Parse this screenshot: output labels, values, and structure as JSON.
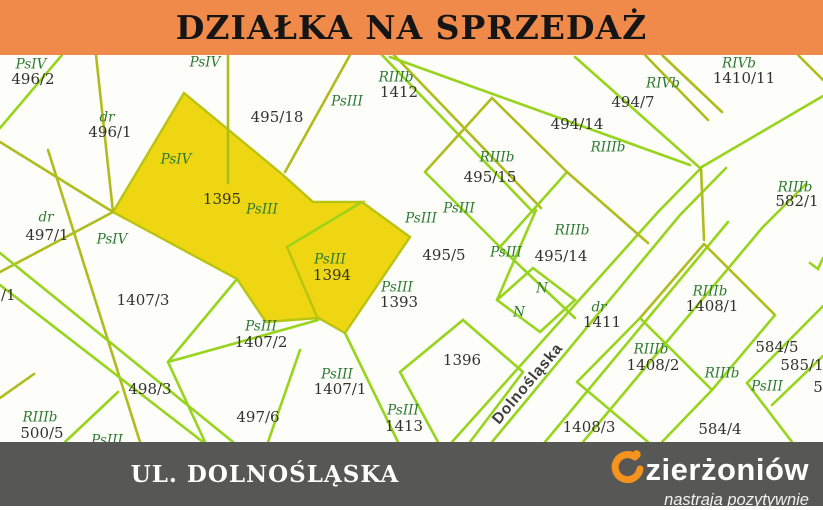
{
  "header": {
    "title": "DZIAŁKA NA SPRZEDAŻ",
    "bg": "#f08a4b",
    "text_color": "#151515"
  },
  "footer": {
    "street_banner": "UL. DOLNOŚLĄSKA",
    "bg": "#575755",
    "logo": {
      "name_rest": "zierżoniów",
      "tagline": "nastraja pozytywnie",
      "accent": "#f6921e",
      "d_icon": "orange-swirl-D"
    }
  },
  "map": {
    "background": "#fdfdfa",
    "line_colors": {
      "bright": "#97d41c",
      "olive": "#b0bc1e"
    },
    "highlight": {
      "fill": "#eed712",
      "stroke": "#b9c410"
    },
    "label_colors": {
      "code": "#2d7a32",
      "number": "#32322c",
      "street": "#3d3d3d"
    },
    "highlighted_parcels": [
      {
        "number": "1395",
        "code": "PsIII"
      },
      {
        "number": "1394",
        "code": "PsIII"
      }
    ],
    "street": {
      "name": "Dolnośląska",
      "x": 528,
      "y": 384,
      "angle": -50
    },
    "labels": [
      {
        "t": "PsIV",
        "k": "code",
        "x": 31,
        "y": 65
      },
      {
        "t": "496/2",
        "k": "num",
        "x": 33,
        "y": 80
      },
      {
        "t": "dr",
        "k": "code",
        "x": 107,
        "y": 118
      },
      {
        "t": "496/1",
        "k": "num",
        "x": 110,
        "y": 133
      },
      {
        "t": "PsIV",
        "k": "code",
        "x": 205,
        "y": 63
      },
      {
        "t": "495/18",
        "k": "num",
        "x": 277,
        "y": 118
      },
      {
        "t": "PsIII",
        "k": "code",
        "x": 347,
        "y": 102
      },
      {
        "t": "RIIIb",
        "k": "code",
        "x": 396,
        "y": 78
      },
      {
        "t": "1412",
        "k": "num",
        "x": 399,
        "y": 93
      },
      {
        "t": "PsIV",
        "k": "code",
        "x": 176,
        "y": 160
      },
      {
        "t": "1395",
        "k": "num",
        "x": 222,
        "y": 200
      },
      {
        "t": "PsIII",
        "k": "code",
        "x": 262,
        "y": 210
      },
      {
        "t": "dr",
        "k": "code",
        "x": 46,
        "y": 218
      },
      {
        "t": "497/1",
        "k": "num",
        "x": 47,
        "y": 236
      },
      {
        "t": "PsIV",
        "k": "code",
        "x": 112,
        "y": 240
      },
      {
        "t": "498/1",
        "k": "num",
        "x": -6,
        "y": 296
      },
      {
        "t": "PsIII",
        "k": "code",
        "x": 330,
        "y": 260
      },
      {
        "t": "1394",
        "k": "num",
        "x": 332,
        "y": 276
      },
      {
        "t": "PsIII",
        "k": "code",
        "x": 397,
        "y": 288
      },
      {
        "t": "1393",
        "k": "num",
        "x": 399,
        "y": 303
      },
      {
        "t": "PsIII",
        "k": "code",
        "x": 421,
        "y": 219
      },
      {
        "t": "PsIII",
        "k": "code",
        "x": 459,
        "y": 209
      },
      {
        "t": "495/5",
        "k": "num",
        "x": 444,
        "y": 256
      },
      {
        "t": "PsIII",
        "k": "code",
        "x": 506,
        "y": 253
      },
      {
        "t": "RIIIb",
        "k": "code",
        "x": 497,
        "y": 158
      },
      {
        "t": "495/15",
        "k": "num",
        "x": 490,
        "y": 178
      },
      {
        "t": "RIIIb",
        "k": "code",
        "x": 572,
        "y": 231
      },
      {
        "t": "495/14",
        "k": "num",
        "x": 561,
        "y": 257
      },
      {
        "t": "494/14",
        "k": "num",
        "x": 577,
        "y": 125
      },
      {
        "t": "494/7",
        "k": "num",
        "x": 633,
        "y": 103
      },
      {
        "t": "RIIIb",
        "k": "code",
        "x": 608,
        "y": 148
      },
      {
        "t": "RIVb",
        "k": "code",
        "x": 663,
        "y": 84
      },
      {
        "t": "RIVb",
        "k": "code",
        "x": 739,
        "y": 64
      },
      {
        "t": "1410/11",
        "k": "num",
        "x": 744,
        "y": 79
      },
      {
        "t": "RIIIb",
        "k": "code",
        "x": 795,
        "y": 188
      },
      {
        "t": "582/1",
        "k": "num",
        "x": 797,
        "y": 202
      },
      {
        "t": "N",
        "k": "code",
        "x": 542,
        "y": 289
      },
      {
        "t": "N",
        "k": "code",
        "x": 519,
        "y": 313
      },
      {
        "t": "dr",
        "k": "code",
        "x": 599,
        "y": 308
      },
      {
        "t": "1411",
        "k": "num",
        "x": 602,
        "y": 323
      },
      {
        "t": "1407/3",
        "k": "num",
        "x": 143,
        "y": 301
      },
      {
        "t": "PsIII",
        "k": "code",
        "x": 261,
        "y": 327
      },
      {
        "t": "1407/2",
        "k": "num",
        "x": 261,
        "y": 343
      },
      {
        "t": "498/3",
        "k": "num",
        "x": 150,
        "y": 390
      },
      {
        "t": "497/6",
        "k": "num",
        "x": 258,
        "y": 418
      },
      {
        "t": "PsIII",
        "k": "code",
        "x": 337,
        "y": 375
      },
      {
        "t": "1407/1",
        "k": "num",
        "x": 340,
        "y": 390
      },
      {
        "t": "1396",
        "k": "num",
        "x": 462,
        "y": 361
      },
      {
        "t": "PsIII",
        "k": "code",
        "x": 403,
        "y": 411
      },
      {
        "t": "1413",
        "k": "num",
        "x": 404,
        "y": 427
      },
      {
        "t": "RIIIb",
        "k": "code",
        "x": 40,
        "y": 418
      },
      {
        "t": "500/5",
        "k": "num",
        "x": 42,
        "y": 434
      },
      {
        "t": "PsIII",
        "k": "code",
        "x": 107,
        "y": 441
      },
      {
        "t": "1408/3",
        "k": "num",
        "x": 589,
        "y": 428
      },
      {
        "t": "RIIIb",
        "k": "code",
        "x": 710,
        "y": 292
      },
      {
        "t": "1408/1",
        "k": "num",
        "x": 712,
        "y": 307
      },
      {
        "t": "RIIIb",
        "k": "code",
        "x": 651,
        "y": 350
      },
      {
        "t": "1408/2",
        "k": "num",
        "x": 653,
        "y": 366
      },
      {
        "t": "RIIIb",
        "k": "code",
        "x": 722,
        "y": 374
      },
      {
        "t": "584/5",
        "k": "num",
        "x": 777,
        "y": 348
      },
      {
        "t": "585/1",
        "k": "num",
        "x": 802,
        "y": 366
      },
      {
        "t": "PsIII",
        "k": "code",
        "x": 767,
        "y": 387
      },
      {
        "t": "5",
        "k": "num",
        "x": 818,
        "y": 388
      },
      {
        "t": "584/4",
        "k": "num",
        "x": 720,
        "y": 430
      }
    ],
    "polygons": [
      {
        "name": "parcel-1395",
        "pts": "184,93 283,175 313,202 362,202 287,247 318,318 266,322 237,279 113,212"
      },
      {
        "name": "parcel-1394",
        "pts": "287,247 362,202 410,237 345,333 317,317"
      }
    ],
    "lines": [
      {
        "c": "olive",
        "p": "0,142 113,212"
      },
      {
        "c": "olive",
        "p": "113,212 0,272"
      },
      {
        "c": "olive",
        "p": "96,55 113,212"
      },
      {
        "c": "bright",
        "p": "62,55 0,128"
      },
      {
        "c": "olive",
        "p": "48,150 140,442"
      },
      {
        "c": "bright",
        "p": "0,253 233,442"
      },
      {
        "c": "bright",
        "p": "0,285 203,442"
      },
      {
        "c": "bright",
        "p": "65,442 118,392"
      },
      {
        "c": "olive",
        "p": "0,398 34,374"
      },
      {
        "c": "olive",
        "p": "228,55 228,183"
      },
      {
        "c": "olive",
        "p": "350,55 285,172"
      },
      {
        "c": "bright",
        "p": "382,55 533,212"
      },
      {
        "c": "olive",
        "p": "394,55 541,208"
      },
      {
        "c": "bright",
        "p": "390,57 690,165"
      },
      {
        "c": "bright",
        "p": "536,210 497,300"
      },
      {
        "c": "bright",
        "p": "237,279 168,362"
      },
      {
        "c": "bright",
        "p": "168,362 247,340 318,320"
      },
      {
        "c": "bright",
        "p": "168,362 205,442"
      },
      {
        "c": "bright",
        "p": "300,350 268,442"
      },
      {
        "c": "bright",
        "p": "345,333 398,442"
      },
      {
        "c": "bright",
        "p": "400,372 463,320 523,372"
      },
      {
        "c": "bright",
        "p": "523,372 470,442"
      },
      {
        "c": "bright",
        "p": "400,372 438,442"
      },
      {
        "c": "bright",
        "p": "452,442 658,212 703,166"
      },
      {
        "c": "bright",
        "p": "492,442 680,215 726,168"
      },
      {
        "c": "bright",
        "p": "545,442 728,222"
      },
      {
        "c": "bright",
        "p": "583,442 762,228 806,184"
      },
      {
        "c": "bright",
        "p": "497,300 533,268 575,300 540,332 497,300"
      },
      {
        "c": "olive",
        "p": "492,98 425,172"
      },
      {
        "c": "olive",
        "p": "492,98 567,172"
      },
      {
        "c": "bright",
        "p": "425,172 500,247"
      },
      {
        "c": "bright",
        "p": "567,172 500,247"
      },
      {
        "c": "bright",
        "p": "500,247 575,318"
      },
      {
        "c": "olive",
        "p": "567,172 648,243"
      },
      {
        "c": "bright",
        "p": "575,57 700,168"
      },
      {
        "c": "bright",
        "p": "700,168 823,96"
      },
      {
        "c": "olive",
        "p": "645,55 708,120"
      },
      {
        "c": "olive",
        "p": "662,55 722,112"
      },
      {
        "c": "olive",
        "p": "701,168 704,240"
      },
      {
        "c": "olive",
        "p": "704,244 640,318"
      },
      {
        "c": "olive",
        "p": "704,244 775,315"
      },
      {
        "c": "bright",
        "p": "640,318 712,390"
      },
      {
        "c": "bright",
        "p": "775,315 712,390"
      },
      {
        "c": "bright",
        "p": "640,318 577,382"
      },
      {
        "c": "bright",
        "p": "577,382 648,442"
      },
      {
        "c": "bright",
        "p": "712,390 662,442"
      },
      {
        "c": "bright",
        "p": "823,306 747,383"
      },
      {
        "c": "bright",
        "p": "747,383 792,442"
      },
      {
        "c": "bright",
        "p": "823,356 772,405"
      },
      {
        "c": "olive",
        "p": "798,55 823,80"
      },
      {
        "c": "bright",
        "p": "810,263 818,269 823,258"
      }
    ]
  }
}
